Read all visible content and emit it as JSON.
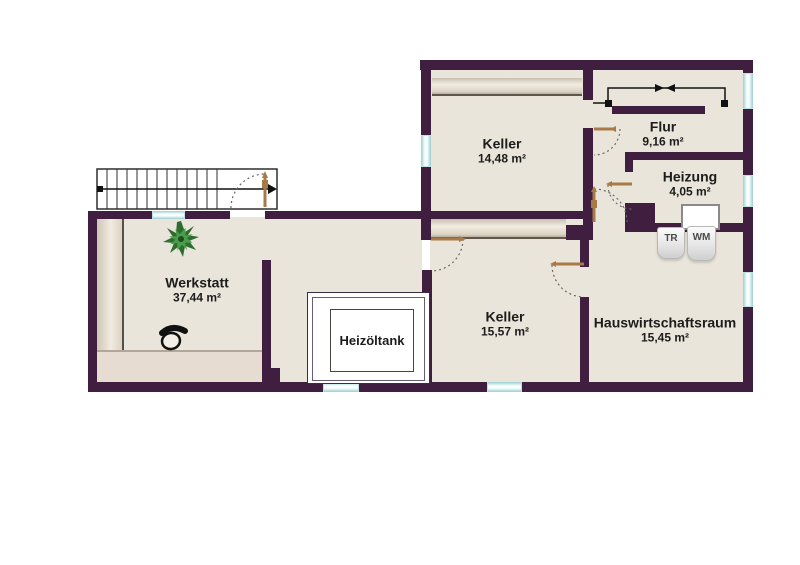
{
  "plan_title": "Kellergeschoss Grundriss",
  "rooms": {
    "werkstatt": {
      "name": "Werkstatt",
      "area": "37,44 m²"
    },
    "keller_nord": {
      "name": "Keller",
      "area": "14,48 m²"
    },
    "keller_sued": {
      "name": "Keller",
      "area": "15,57 m²"
    },
    "flur": {
      "name": "Flur",
      "area": "9,16 m²"
    },
    "heizung": {
      "name": "Heizung",
      "area": "4,05 m²"
    },
    "hwr": {
      "name": "Hauswirtschaftsraum",
      "area": "15,45 m²"
    },
    "heizoeltank": {
      "name": "Heizöltank"
    }
  },
  "appliances": {
    "dryer": "TR",
    "washer": "WM"
  },
  "symbols": {
    "staircase": "staircase-icon",
    "stair_direction": "stair-direction-arrows-icon",
    "plant": "plant-icon",
    "chair": "chair-icon",
    "door": "door-swing-icon",
    "window": "window-icon"
  },
  "colors": {
    "wall": "#401e40",
    "floor": "#e9e5da",
    "window": "#eefafa",
    "window-edge": "#9ccdd1",
    "door": "#a87a48",
    "text": "#1c1c1c"
  }
}
